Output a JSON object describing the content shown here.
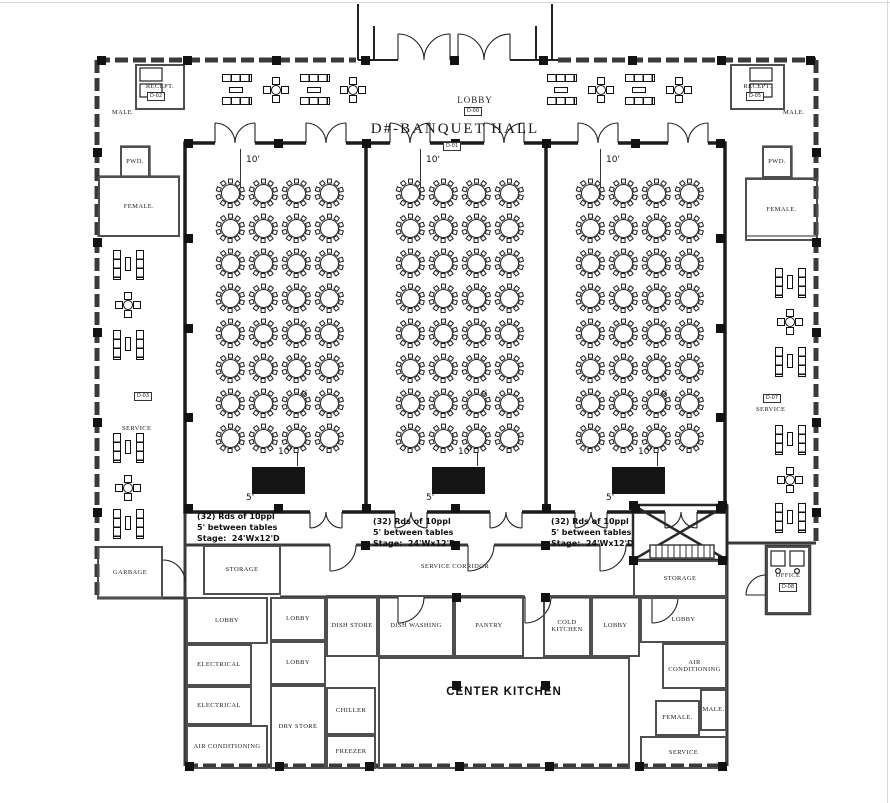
{
  "title": {
    "text": "D#-BANQUET HALL",
    "tag": "D-01"
  },
  "lobby": {
    "text": "LOBBY",
    "tag": "D-00"
  },
  "annotation": {
    "lines": [
      "(32) Rds of 10ppl",
      "5' between tables",
      "Stage:  24'Wx12'D"
    ],
    "positions": [
      {
        "x": 197,
        "y": 511
      },
      {
        "x": 373,
        "y": 516
      },
      {
        "x": 551,
        "y": 516
      }
    ]
  },
  "dimensions": {
    "ten": "10'",
    "five": "5'"
  },
  "halls": {
    "tables_per_section": 32,
    "seats_per_table": 10,
    "w": 175,
    "h": 364,
    "sections": [
      {
        "x": 188,
        "y": 145
      },
      {
        "x": 368,
        "y": 145
      },
      {
        "x": 548,
        "y": 145
      }
    ],
    "cols": [
      42,
      75,
      108,
      141
    ],
    "rows": [
      48,
      83,
      118,
      153,
      188,
      223,
      258,
      293
    ],
    "stage": {
      "x": 64,
      "y": 322,
      "w": 53,
      "h": 27
    }
  },
  "service_labels": [
    {
      "text": "SERVICE",
      "tag": "D-03",
      "x": 122,
      "y": 425,
      "tagx": 134,
      "tagy": 392
    },
    {
      "text": "SERVICE",
      "tag": "D-07",
      "x": 756,
      "y": 406,
      "tagx": 763,
      "tagy": 394
    }
  ],
  "rooms": [
    {
      "label": "RECEPT.",
      "x": 135,
      "y": 64,
      "w": 50,
      "h": 46,
      "tag": "D-02",
      "tagx": 147,
      "tagy": 92
    },
    {
      "label": "MALE.",
      "x": 100,
      "y": 106,
      "w": 46,
      "h": 13,
      "nb": true
    },
    {
      "label": "PWD.",
      "x": 120,
      "y": 146,
      "w": 30,
      "h": 32
    },
    {
      "label": "FEMALE.",
      "x": 98,
      "y": 176,
      "w": 82,
      "h": 61
    },
    {
      "label": "RECEPT.",
      "x": 730,
      "y": 64,
      "w": 55,
      "h": 46,
      "tag": "D-05",
      "tagx": 746,
      "tagy": 92
    },
    {
      "label": "MALE.",
      "x": 770,
      "y": 106,
      "w": 48,
      "h": 13,
      "nb": true
    },
    {
      "label": "PWD.",
      "x": 762,
      "y": 146,
      "w": 30,
      "h": 32
    },
    {
      "label": "FEMALE.",
      "x": 745,
      "y": 178,
      "w": 73,
      "h": 63
    },
    {
      "label": "GARBAGE",
      "x": 97,
      "y": 546,
      "w": 66,
      "h": 53
    },
    {
      "label": "STORAGE",
      "x": 203,
      "y": 545,
      "w": 78,
      "h": 50
    },
    {
      "label": "LOBBY",
      "x": 186,
      "y": 597,
      "w": 82,
      "h": 47
    },
    {
      "label": "ELECTRICAL",
      "x": 186,
      "y": 644,
      "w": 66,
      "h": 42
    },
    {
      "label": "ELECTRICAL",
      "x": 186,
      "y": 686,
      "w": 66,
      "h": 39
    },
    {
      "label": "AIR CONDITIONING",
      "x": 186,
      "y": 725,
      "w": 82,
      "h": 44
    },
    {
      "label": "LOBBY",
      "x": 270,
      "y": 597,
      "w": 56,
      "h": 44
    },
    {
      "label": "LOBBY",
      "x": 270,
      "y": 641,
      "w": 56,
      "h": 44
    },
    {
      "label": "DISH STORE",
      "x": 326,
      "y": 595,
      "w": 52,
      "h": 62
    },
    {
      "label": "DRY STORE",
      "x": 270,
      "y": 685,
      "w": 56,
      "h": 84
    },
    {
      "label": "CHILLER",
      "x": 326,
      "y": 687,
      "w": 50,
      "h": 48
    },
    {
      "label": "FREEZER",
      "x": 326,
      "y": 735,
      "w": 50,
      "h": 34
    },
    {
      "label": "DISH WASHING",
      "x": 378,
      "y": 595,
      "w": 76,
      "h": 62
    },
    {
      "label": "PANTRY",
      "x": 454,
      "y": 595,
      "w": 70,
      "h": 62
    },
    {
      "label": "COLD KITCHEN",
      "x": 543,
      "y": 595,
      "w": 48,
      "h": 62
    },
    {
      "label": "LOBBY",
      "x": 591,
      "y": 595,
      "w": 49,
      "h": 62
    },
    {
      "label": "CENTER KITCHEN",
      "x": 378,
      "y": 657,
      "w": 252,
      "h": 112,
      "big": true,
      "ly": 684
    },
    {
      "label": "STORAGE",
      "x": 633,
      "y": 560,
      "w": 94,
      "h": 37
    },
    {
      "label": "LOBBY",
      "x": 640,
      "y": 597,
      "w": 87,
      "h": 46
    },
    {
      "label": "AIR CONDITIONING",
      "x": 662,
      "y": 643,
      "w": 65,
      "h": 46
    },
    {
      "label": "MALE.",
      "x": 700,
      "y": 689,
      "w": 27,
      "h": 42
    },
    {
      "label": "FEMALE.",
      "x": 655,
      "y": 700,
      "w": 45,
      "h": 36
    },
    {
      "label": "SERVICE",
      "x": 640,
      "y": 736,
      "w": 87,
      "h": 33
    },
    {
      "label": "OFFICE",
      "x": 766,
      "y": 546,
      "w": 44,
      "h": 68,
      "ly": 570,
      "tag": "D-08",
      "tagx": 779,
      "tagy": 583
    },
    {
      "label": "SERVICE CORRIDOR",
      "x": 388,
      "y": 560,
      "w": 134,
      "h": 14,
      "nb": true
    }
  ],
  "furniture": {
    "top": [
      {
        "type": "sofa",
        "cx": 237,
        "cy": 90
      },
      {
        "type": "t4",
        "cx": 276,
        "cy": 90
      },
      {
        "type": "sofa",
        "cx": 315,
        "cy": 90
      },
      {
        "type": "t4",
        "cx": 353,
        "cy": 90
      },
      {
        "type": "sofa",
        "cx": 562,
        "cy": 90
      },
      {
        "type": "t4",
        "cx": 601,
        "cy": 90
      },
      {
        "type": "sofa",
        "cx": 640,
        "cy": 90
      },
      {
        "type": "t4",
        "cx": 679,
        "cy": 90
      }
    ],
    "left": [
      {
        "type": "sofa-v",
        "cx": 128,
        "cy": 265
      },
      {
        "type": "t4",
        "cx": 128,
        "cy": 305
      },
      {
        "type": "sofa-v",
        "cx": 128,
        "cy": 345
      },
      {
        "type": "sofa-v",
        "cx": 128,
        "cy": 448
      },
      {
        "type": "t4",
        "cx": 128,
        "cy": 488
      },
      {
        "type": "sofa-v",
        "cx": 128,
        "cy": 524
      }
    ],
    "right": [
      {
        "type": "sofa-v",
        "cx": 790,
        "cy": 283
      },
      {
        "type": "t4",
        "cx": 790,
        "cy": 322
      },
      {
        "type": "sofa-v",
        "cx": 790,
        "cy": 362
      },
      {
        "type": "sofa-v",
        "cx": 790,
        "cy": 440
      },
      {
        "type": "t4",
        "cx": 790,
        "cy": 480
      },
      {
        "type": "sofa-v",
        "cx": 790,
        "cy": 518
      }
    ]
  }
}
